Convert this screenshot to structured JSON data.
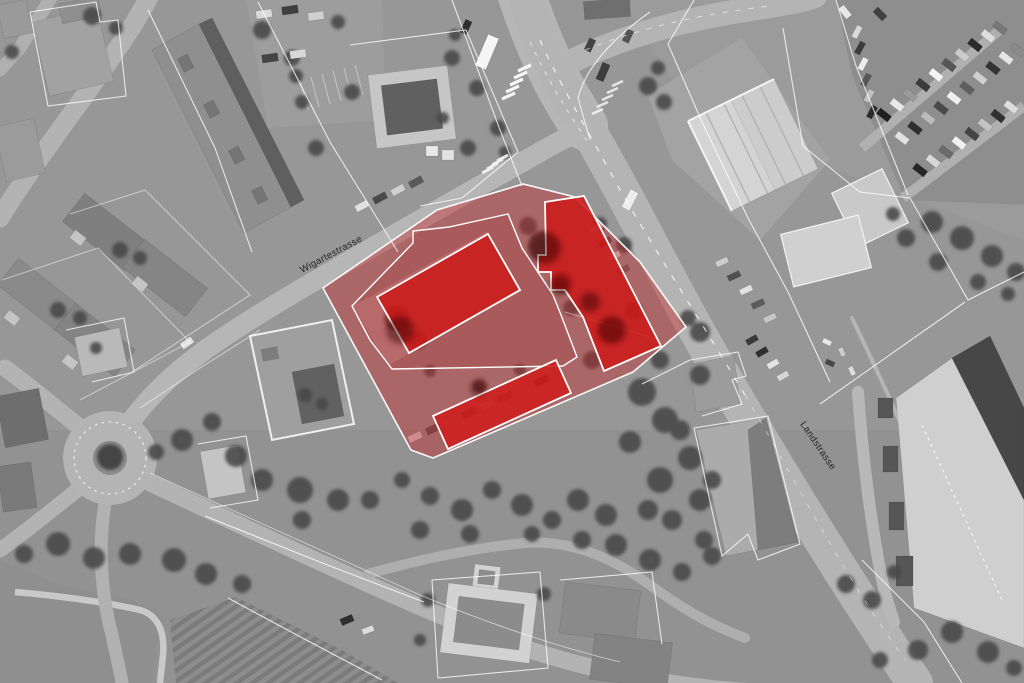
{
  "map": {
    "street_labels": [
      {
        "id": "wigartestrasse",
        "text": "Wigartestrasse"
      },
      {
        "id": "landstrasse",
        "text": "Landstrasse"
      }
    ],
    "overlay": {
      "site_area_fill": "#c92727",
      "highlighted_building_fill": "#cb1717",
      "boundary_stroke": "#ffffff"
    }
  }
}
